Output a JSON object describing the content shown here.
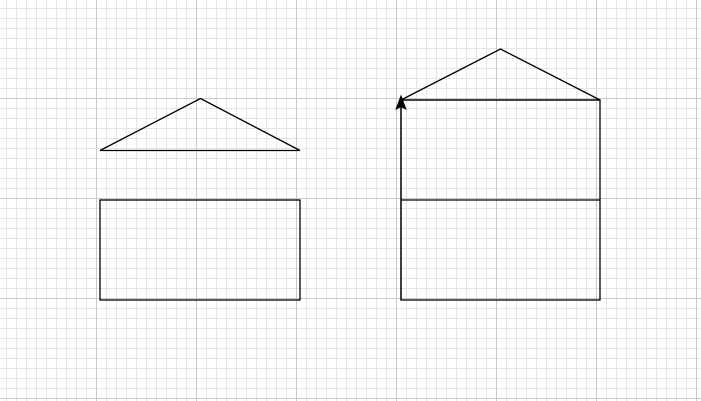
{
  "canvas": {
    "width": 701,
    "height": 401,
    "background_color": "#ffffff",
    "description": "blank drawing canvas with graph-paper grid and two outlined house figures"
  },
  "grid": {
    "minor_spacing": 10,
    "major_spacing": 100,
    "minor_color": "#e5e5e5",
    "major_color": "#c9c9c9",
    "minor_offset_x": 6,
    "minor_offset_y": 8,
    "major_offset_x": 96,
    "major_offset_y": 98
  },
  "stroke": {
    "color": "#000000",
    "width": 1.3
  },
  "shapes": [
    {
      "id": "small-house-roof-triangle",
      "type": "polygon",
      "points": [
        [
          100,
          150.5
        ],
        [
          200.5,
          98.5
        ],
        [
          300,
          150.5
        ]
      ]
    },
    {
      "id": "small-house-body-rectangle",
      "type": "rect",
      "x": 100,
      "y": 200,
      "w": 200,
      "h": 100
    },
    {
      "id": "large-house-roof-triangle",
      "type": "polygon",
      "points": [
        [
          401,
          100
        ],
        [
          500.5,
          49
        ],
        [
          600,
          100
        ]
      ]
    },
    {
      "id": "large-house-body-rectangle",
      "type": "rect",
      "x": 401,
      "y": 100,
      "w": 199,
      "h": 200
    },
    {
      "id": "large-house-divider-line",
      "type": "line",
      "x1": 401,
      "y1": 200,
      "x2": 600,
      "y2": 200
    },
    {
      "id": "upward-arrow-connector",
      "type": "arrow",
      "x1": 401,
      "y1": 300,
      "x2": 401,
      "y2": 96,
      "head_half_width": 4.8,
      "head_length": 13,
      "head_notch": 10.5
    }
  ]
}
